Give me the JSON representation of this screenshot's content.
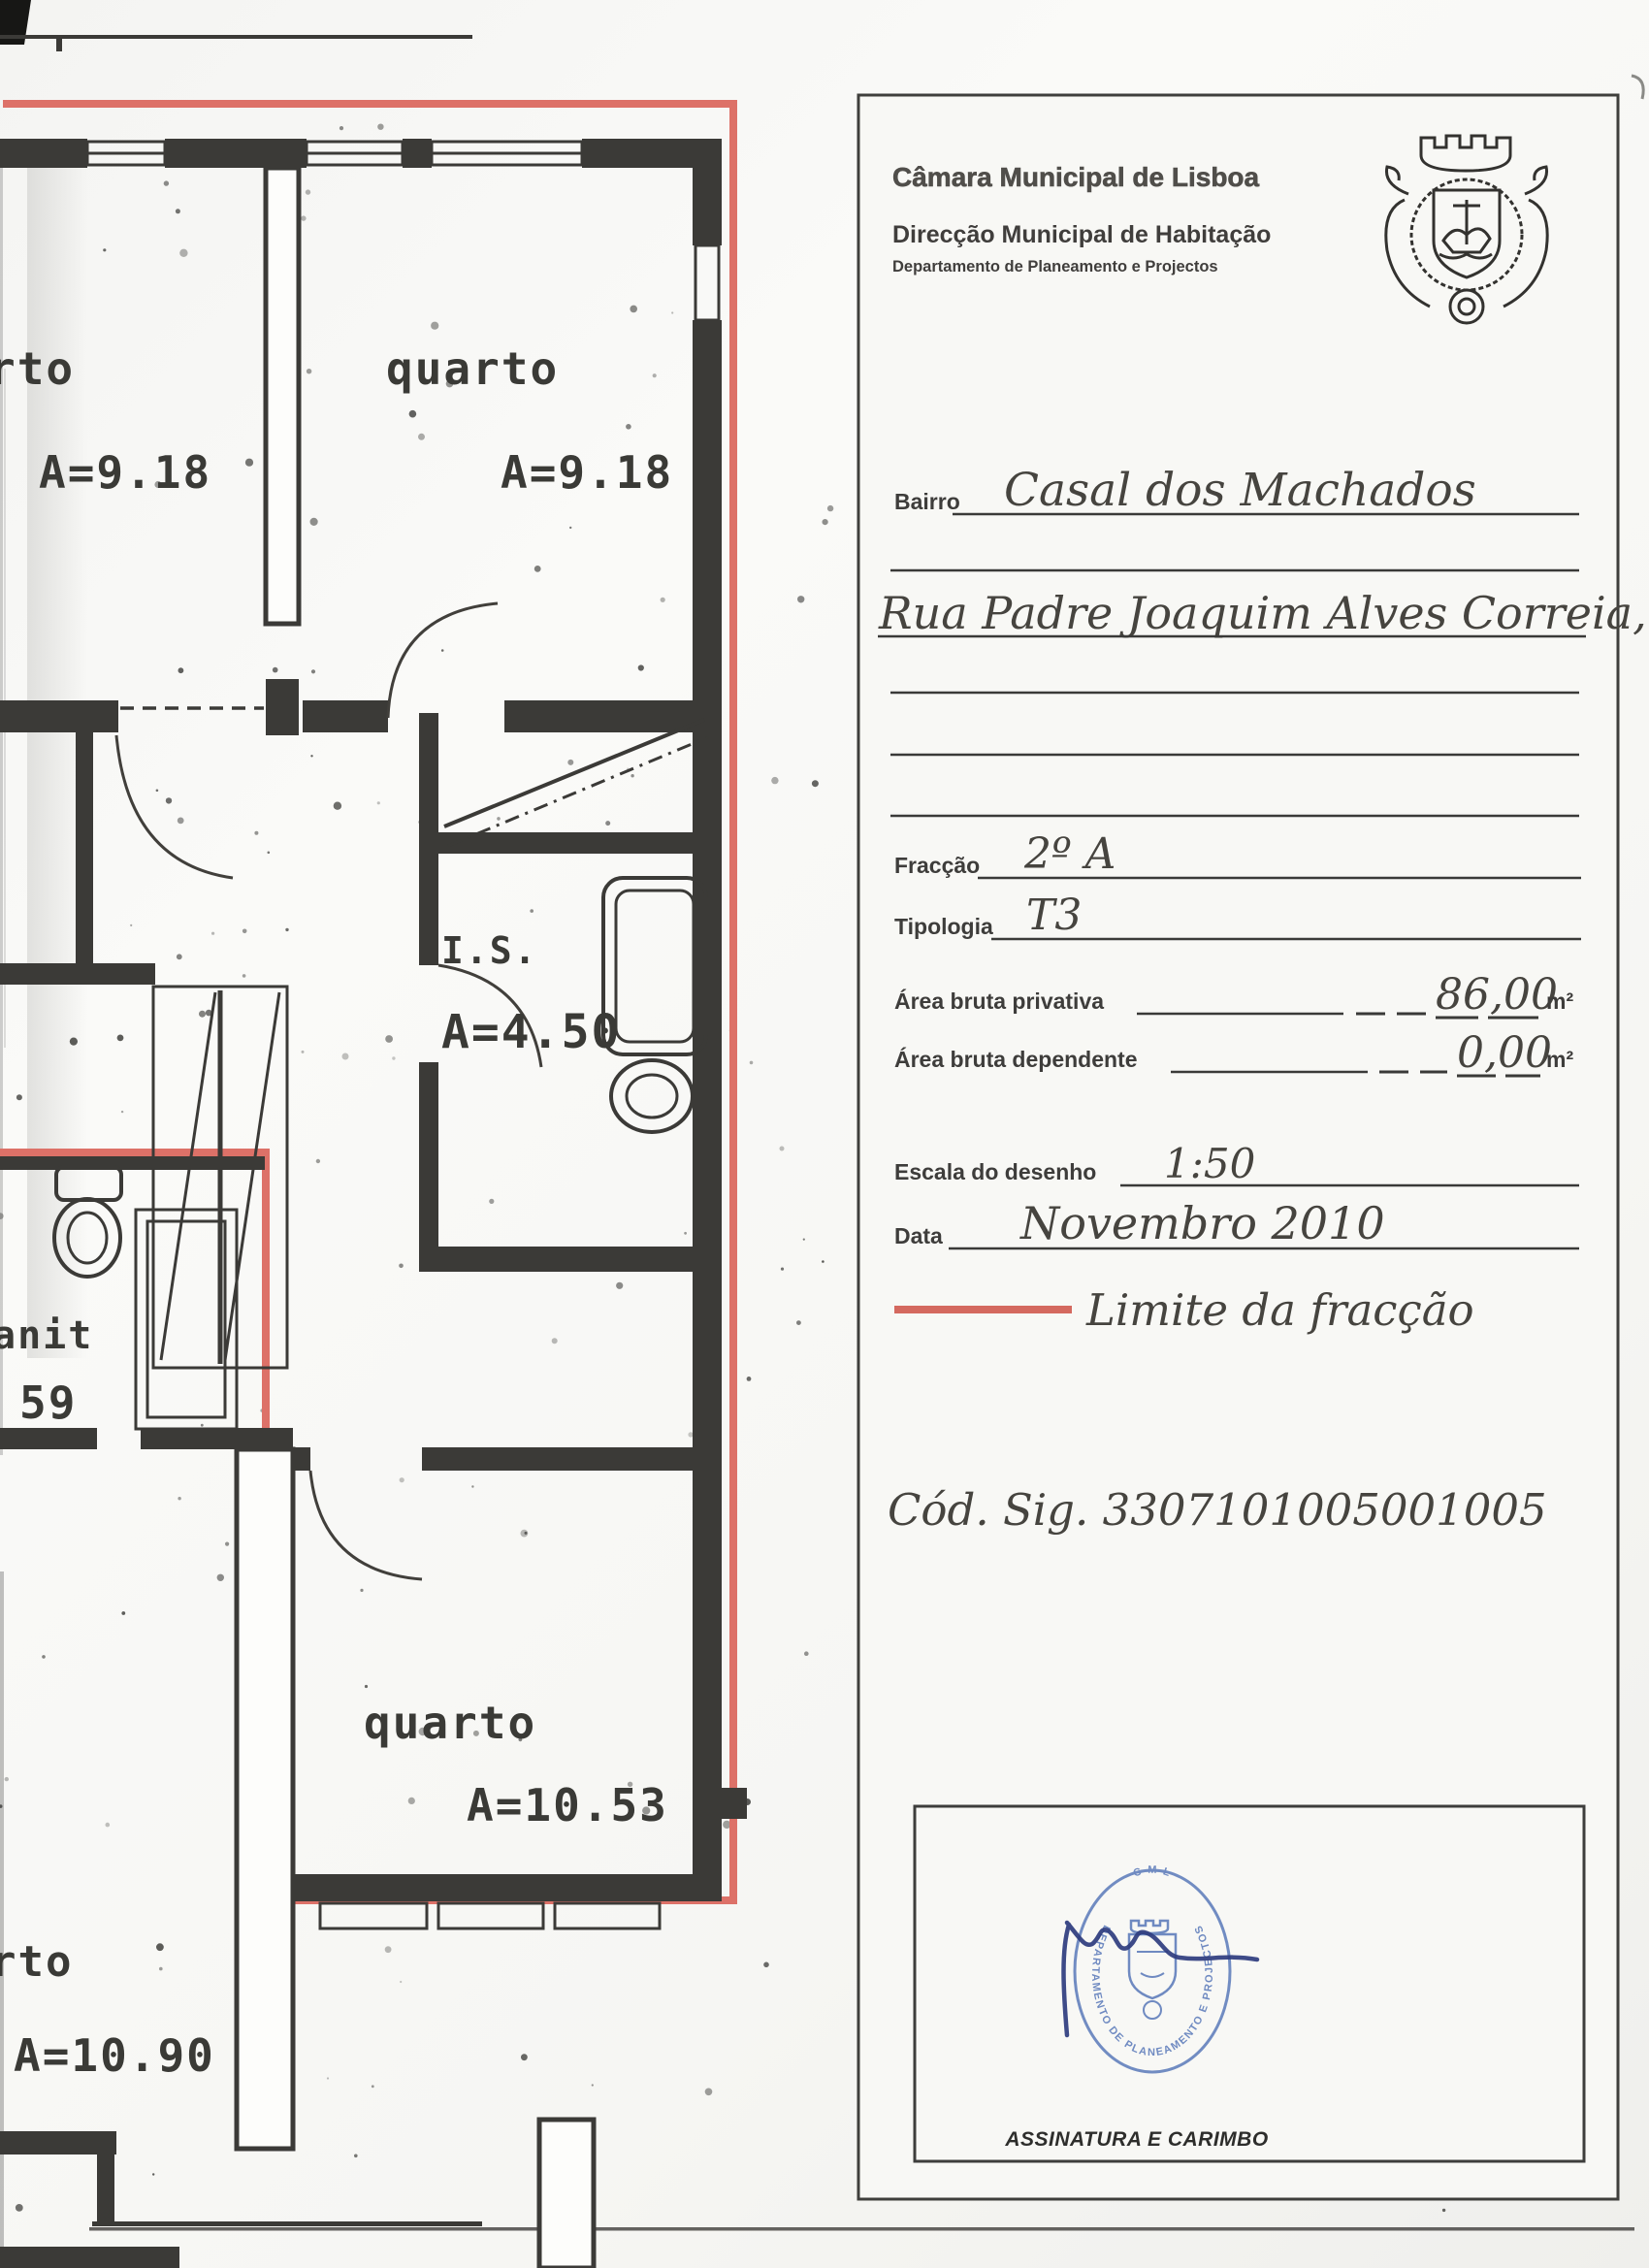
{
  "header": {
    "municipality": "Câmara Municipal de Lisboa",
    "directorate": "Direcção Municipal de Habitação",
    "department": "Departamento de Planeamento e Projectos",
    "crest_icon": "lisbon-coat-of-arms"
  },
  "form": {
    "bairro_label": "Bairro",
    "bairro_value": "Casal dos Machados",
    "address_value": "Rua Padre Joaquim Alves Correia, nº 6",
    "fraccao_label": "Fracção",
    "fraccao_value": "2º A",
    "tipologia_label": "Tipologia",
    "tipologia_value": "T3",
    "area_privativa_label": "Área bruta privativa",
    "area_privativa_value": "86,00",
    "area_dependente_label": "Área bruta dependente",
    "area_dependente_value": "0,00",
    "area_unit": "m²",
    "escala_label": "Escala do desenho",
    "escala_value": "1:50",
    "data_label": "Data",
    "data_value": "Novembro 2010",
    "legend_label": "Limite da fracção",
    "legend_color": "#d4695f",
    "cod_sig": "Cód. Sig. 3307101005001005"
  },
  "signature": {
    "label": "ASSINATURA E CARIMBO",
    "stamp_top": "C M L",
    "stamp_ring_text": "DEPARTAMENTO DE PLANEAMENTO E PROJECTOS",
    "stamp_color": "#6381bd",
    "ink_color": "#2e3c7e"
  },
  "plan": {
    "boundary_color": "#dd7168",
    "rooms": [
      {
        "label": "rto",
        "area": "A=9.18"
      },
      {
        "label": "quarto",
        "area": "A=9.18"
      },
      {
        "label": "I.S.",
        "area": "A=4.50"
      },
      {
        "label": "anit",
        "area": "59"
      },
      {
        "label": "quarto",
        "area": "A=10.53"
      },
      {
        "label": "rto",
        "area": "A=10.90"
      }
    ]
  }
}
